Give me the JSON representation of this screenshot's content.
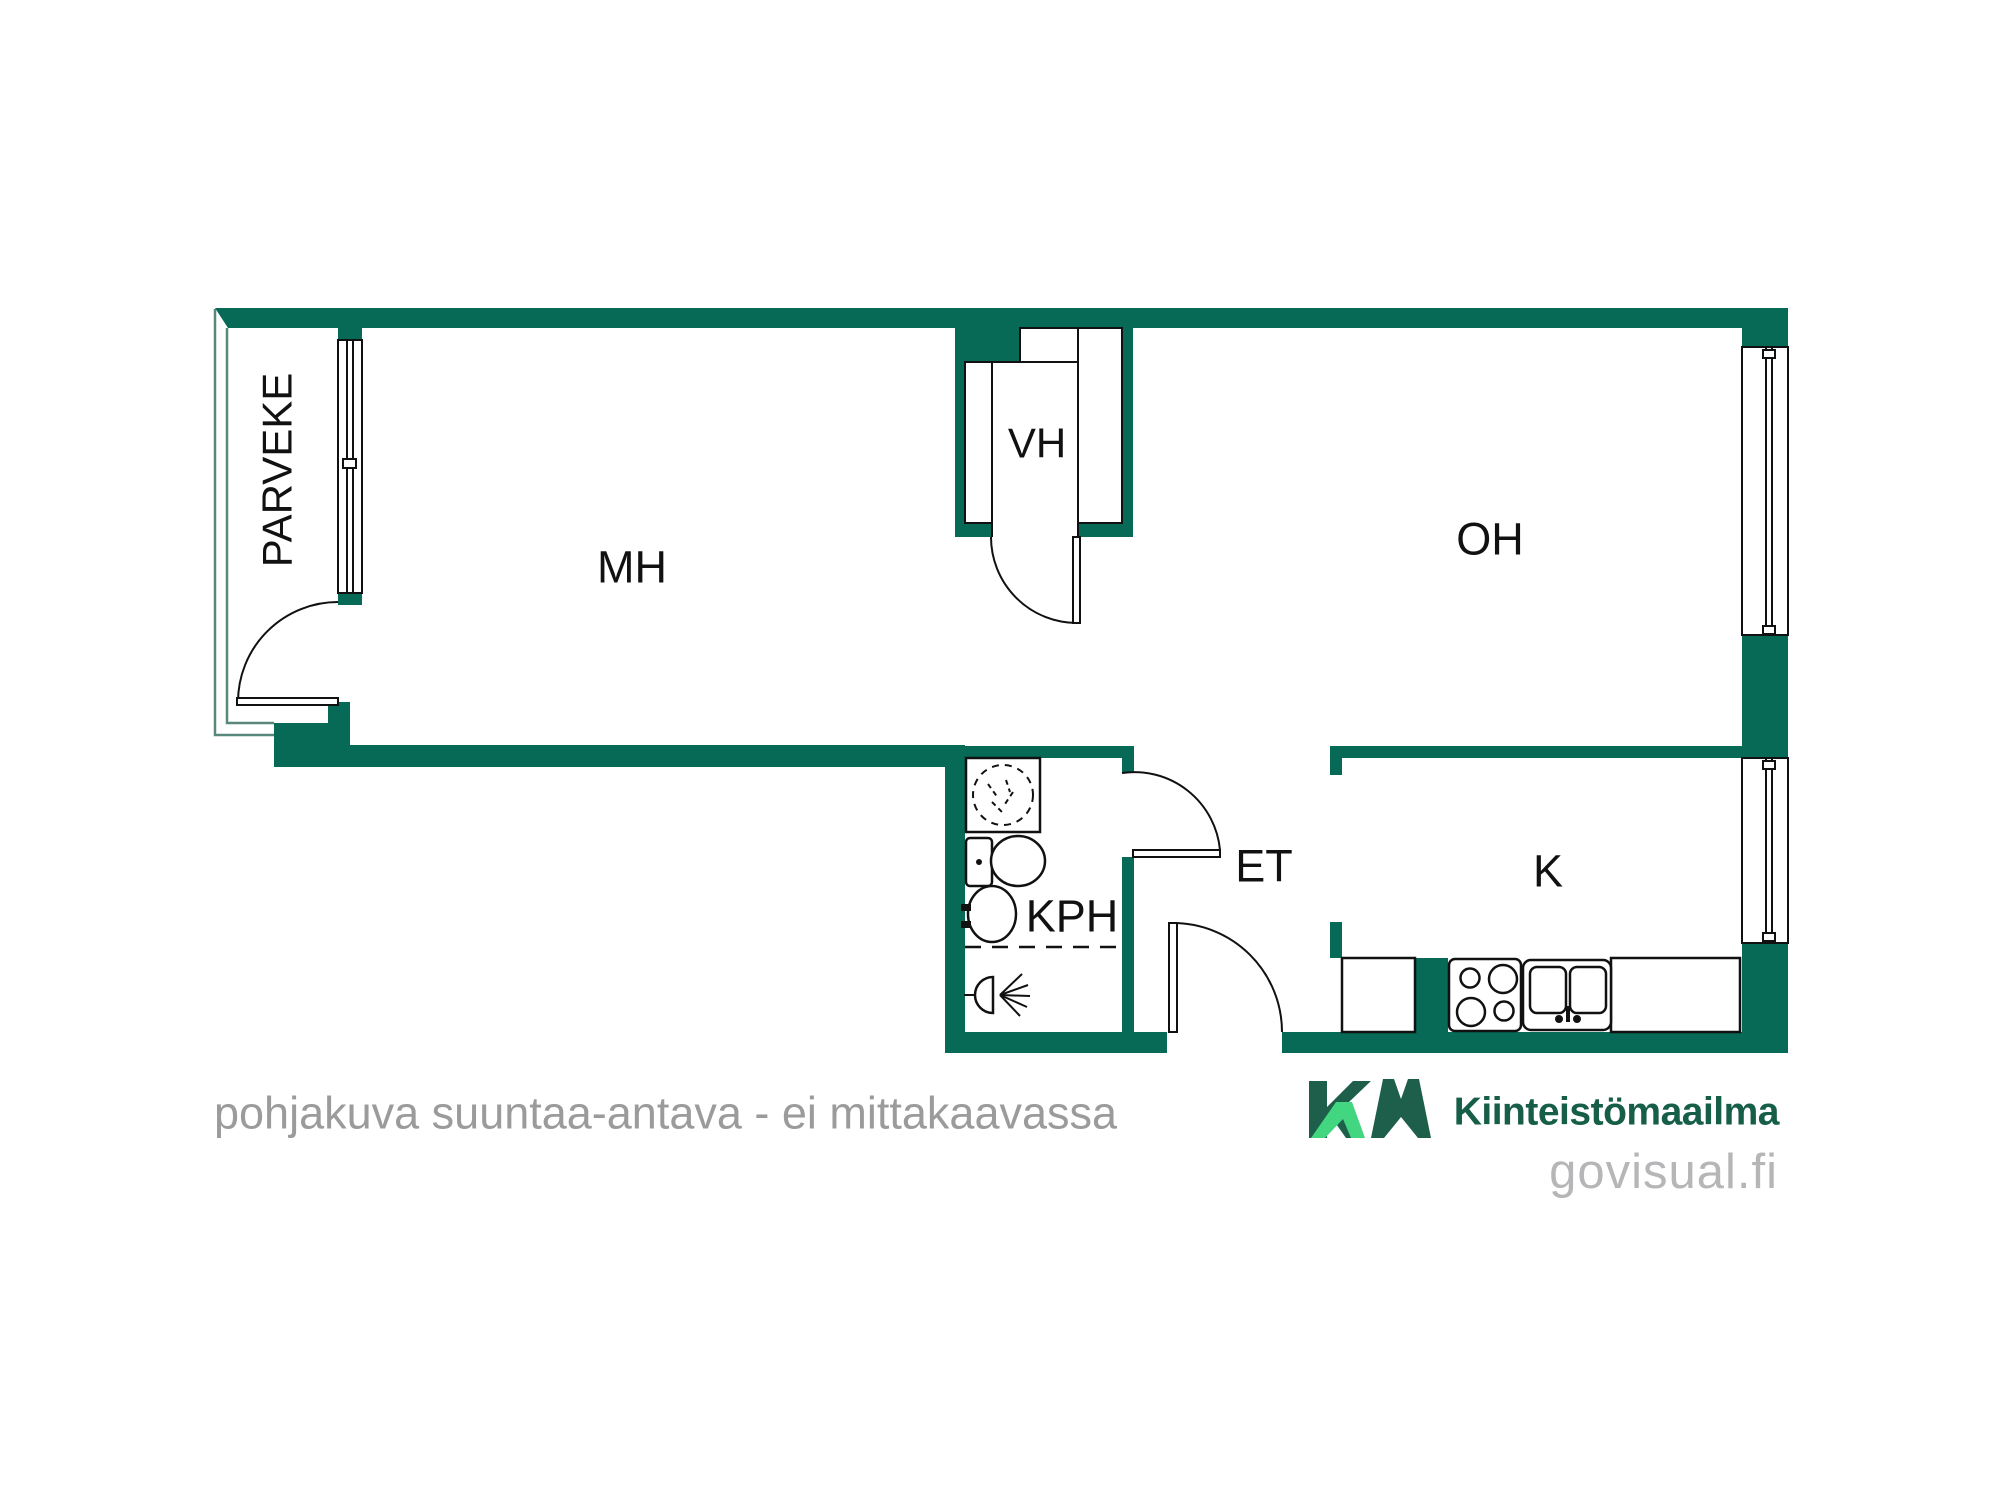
{
  "colors": {
    "wall": "#066A56",
    "railing": "#5A877C",
    "outline": "#111111",
    "logo_dark": "#1E5F4B",
    "logo_light": "#41D67F",
    "brand_text": "#175E49",
    "watermark_gray": "#B6B6B8",
    "disclaimer_gray": "#9B9B9B"
  },
  "rooms": {
    "balcony": "PARVEKE",
    "bedroom": "MH",
    "closet": "VH",
    "living_room": "OH",
    "bathroom": "KPH",
    "hallway": "ET",
    "kitchen": "K"
  },
  "footer": {
    "disclaimer": "pohjakuva suuntaa-antava - ei mittakaavassa",
    "brand": "Kiinteistömaailma",
    "brand_mark": "KM",
    "watermark": "govisual.fi"
  }
}
